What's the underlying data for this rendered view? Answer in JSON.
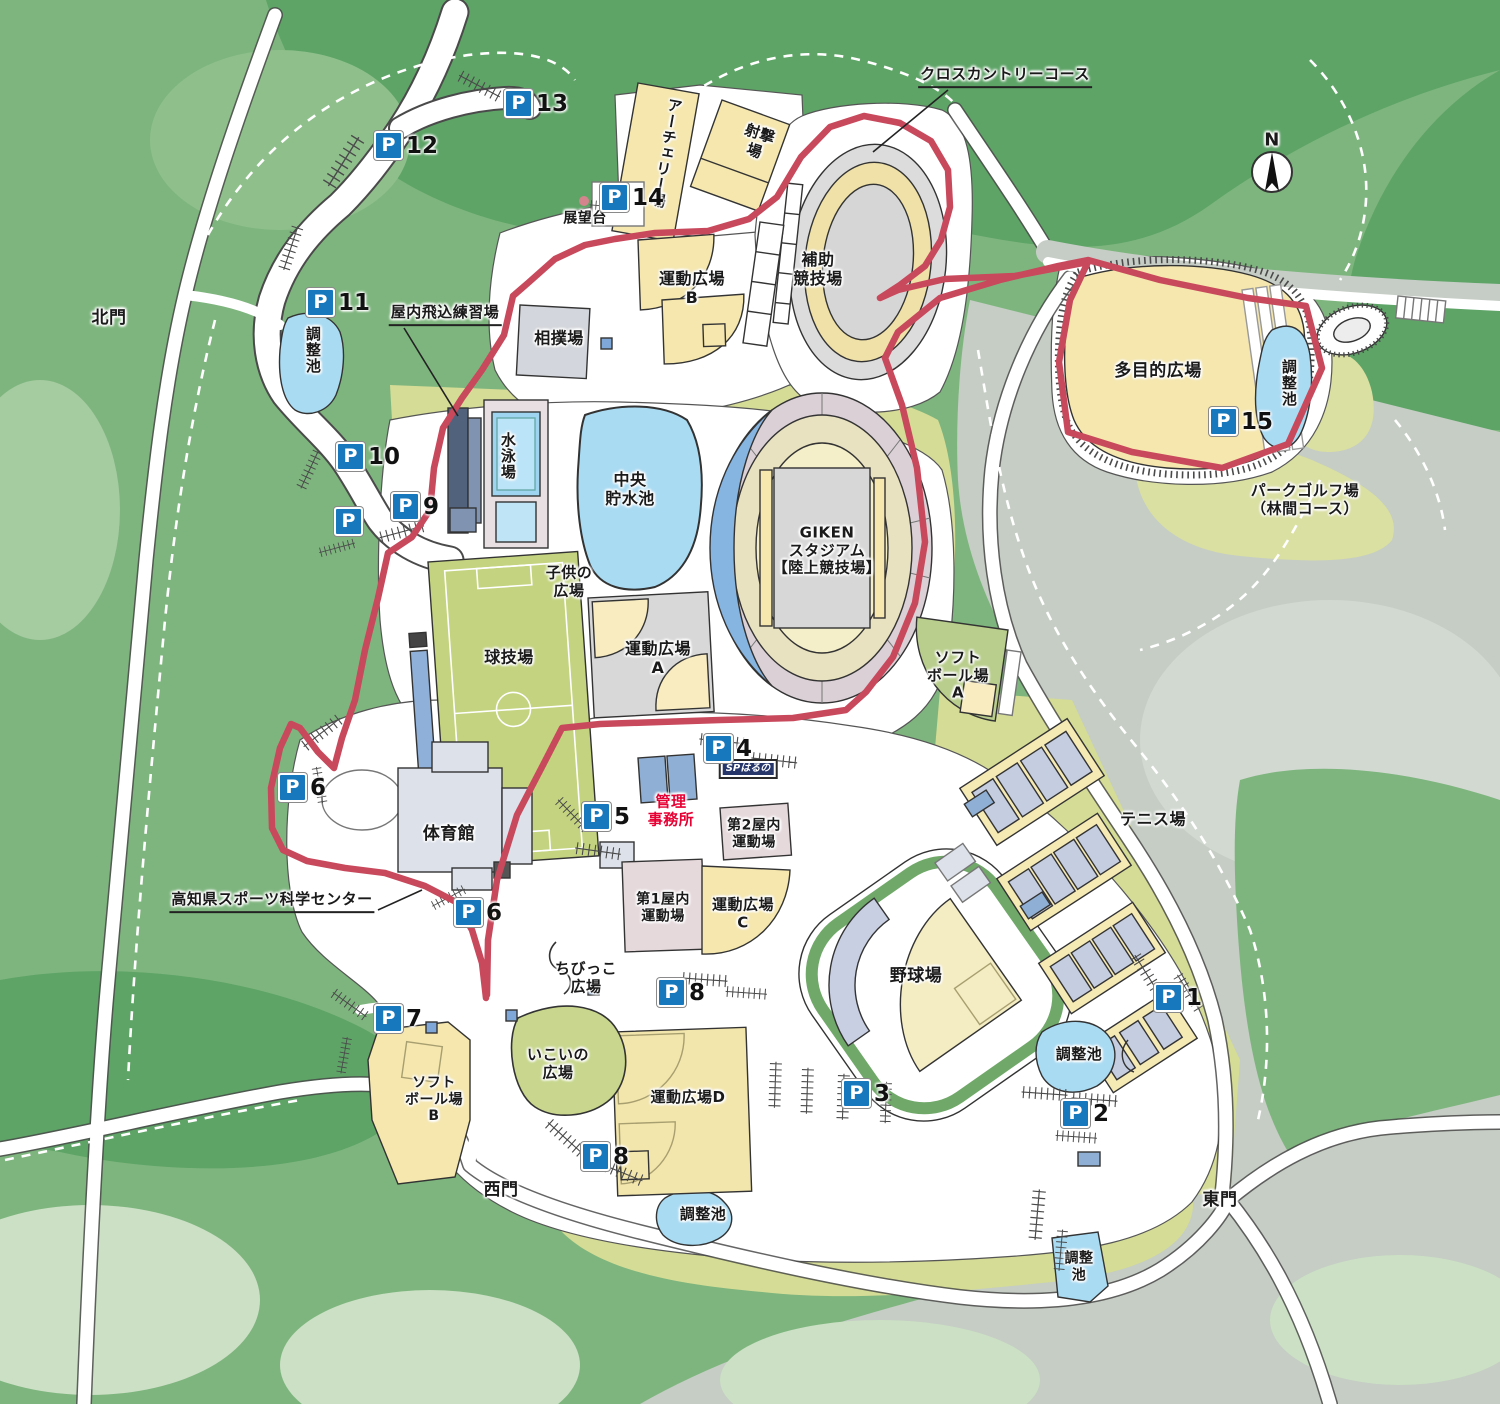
{
  "compass": {
    "label": "N"
  },
  "annotations": {
    "cross_country": "クロスカントリーコース",
    "indoor_diving": "屋内飛込練習場",
    "science_center": "高知県スポーツ科学センター",
    "lookout": "展望台",
    "sp_haruno": "SPはるの"
  },
  "gates": {
    "north": "北門",
    "west": "西門",
    "east": "東門"
  },
  "facilities": {
    "archery": "アーチェリー場",
    "shooting": "射撃\n場",
    "sumo": "相撲場",
    "plaza_b": "運動広場\nB",
    "aux_stadium": "補助\n競技場",
    "multipurpose": "多目的広場",
    "park_golf": "パークゴルフ場\n（林間コース）",
    "swimming": "水泳場",
    "central_reservoir": "中央\n貯水池",
    "giken_stadium": "GIKEN\nスタジアム\n【陸上競技場】",
    "kids_plaza": "子供の\n広場",
    "ball_game": "球技場",
    "plaza_a": "運動広場\nA",
    "softball_a": "ソフト\nボール場\nA",
    "gym": "体育館",
    "admin_office": "管理\n事務所",
    "indoor2": "第2屋内\n運動場",
    "indoor1": "第1屋内\n運動場",
    "plaza_c": "運動広場\nC",
    "baseball": "野球場",
    "tennis": "テニス場",
    "chibikko": "ちびっこ\n広場",
    "ikoi": "いこいの\n広場",
    "plaza_d": "運動広場D",
    "softball_b": "ソフト\nボール場\nB",
    "pond": "調整池",
    "pond_two_line": "調整\n池"
  },
  "parking": {
    "icon": "P",
    "lots": [
      {
        "num": "13"
      },
      {
        "num": "12"
      },
      {
        "num": "14"
      },
      {
        "num": "11"
      },
      {
        "num": "10"
      },
      {
        "num": "9"
      },
      {
        "num": ""
      },
      {
        "num": "15"
      },
      {
        "num": "6"
      },
      {
        "num": "4"
      },
      {
        "num": "5"
      },
      {
        "num": "6"
      },
      {
        "num": "8"
      },
      {
        "num": "7"
      },
      {
        "num": "8"
      },
      {
        "num": "3"
      },
      {
        "num": "1"
      },
      {
        "num": "2"
      }
    ]
  },
  "colors": {
    "forest": "#7EB57E",
    "forest_dark": "#5EA467",
    "forest_pale": "#CBE0C4",
    "hill_gray": "#C5CDC4",
    "lawn": "#D5DC95",
    "building_cream": "#F5E7AE",
    "water": "#A9DBF3",
    "route_red": "#C8485C",
    "parking_blue": "#1778BE",
    "admin_red": "#E60033"
  }
}
